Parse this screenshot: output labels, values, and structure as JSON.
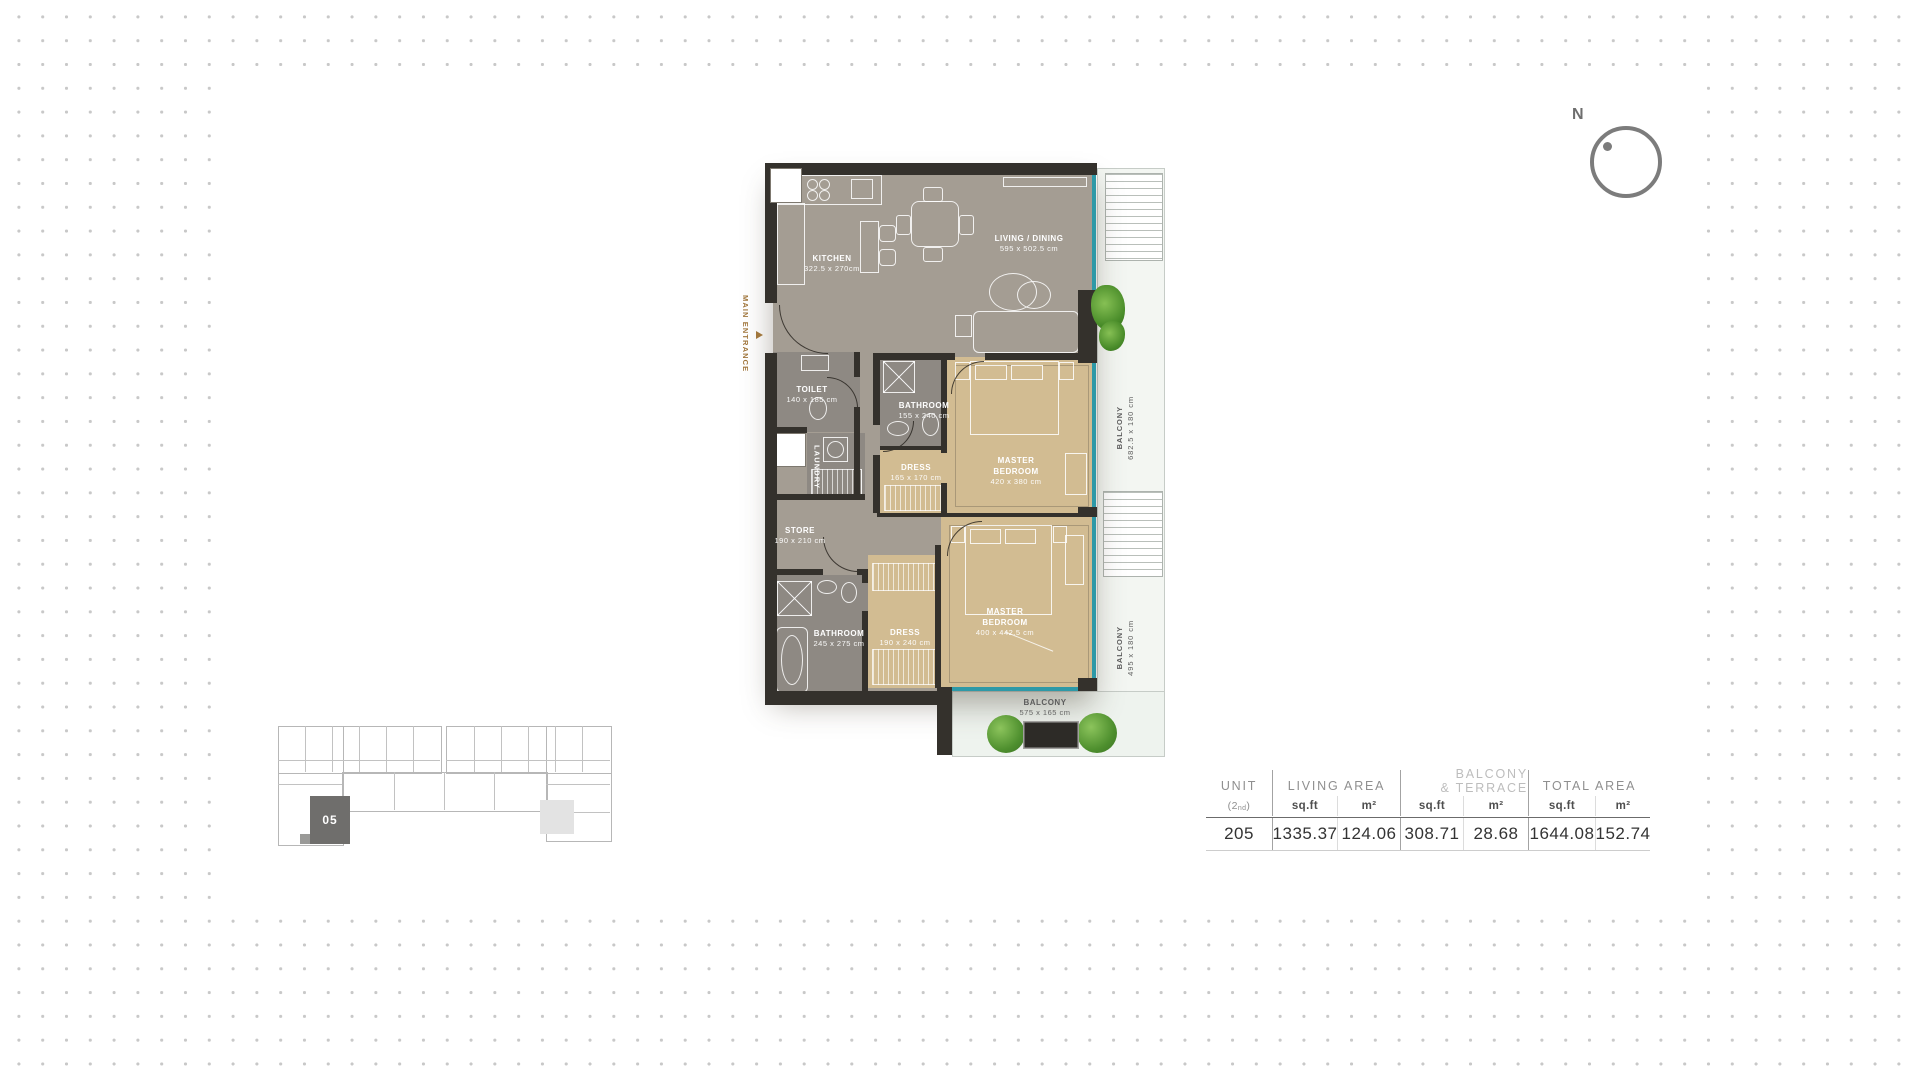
{
  "plan": {
    "entrance_label": "MAIN ENTRANCE",
    "rooms": {
      "kitchen": {
        "name": "KITCHEN",
        "dims": "322.5 x 270cm"
      },
      "living": {
        "name": "LIVING / DINING",
        "dims": "595 x 502.5 cm"
      },
      "toilet": {
        "name": "TOILET",
        "dims": "140 x 185 cm"
      },
      "laundry": {
        "name": "LAUNDRY"
      },
      "store": {
        "name": "STORE",
        "dims": "190 x 210 cm"
      },
      "bathroom_upper": {
        "name": "BATHROOM",
        "dims": "155 x 240 cm"
      },
      "dress_upper": {
        "name": "DRESS",
        "dims": "165 x 170 cm"
      },
      "master_upper": {
        "name": "MASTER BEDROOM",
        "dims": "420 x 380 cm"
      },
      "bathroom_lower": {
        "name": "BATHROOM",
        "dims": "245 x 275 cm"
      },
      "dress_lower": {
        "name": "DRESS",
        "dims": "190 x 240 cm"
      },
      "master_lower": {
        "name": "MASTER BEDROOM",
        "dims": "400 x 442.5 cm"
      },
      "balcony_side_upper": {
        "name": "BALCONY",
        "dims": "682.5 x 180 cm"
      },
      "balcony_side_lower": {
        "name": "BALCONY",
        "dims": "495 x 180 cm"
      },
      "balcony_bottom": {
        "name": "BALCONY",
        "dims": "575 x 165 cm"
      }
    }
  },
  "compass": {
    "north_label": "N"
  },
  "minimap": {
    "unit_label": "05"
  },
  "area_table": {
    "unit_title": "UNIT",
    "floor_open": "(2",
    "floor_sup": "nd",
    "floor_close": ")",
    "living_area_title": "LIVING AREA",
    "balcony_terrace_line1": "BALCONY",
    "balcony_terrace_line2": "& TERRACE",
    "total_area_title": "TOTAL AREA",
    "sqft_label": "sq.ft",
    "m2_label": "m²",
    "row": {
      "unit": "205",
      "living_sqft": "1335.37",
      "living_m2": "124.06",
      "balcony_sqft": "308.71",
      "balcony_m2": "28.68",
      "total_sqft": "1644.08",
      "total_m2": "152.74"
    }
  },
  "colors": {
    "wall": "#34312C",
    "floor_main": "#A49D93",
    "floor_bedroom": "#D2BC92",
    "floor_bath": "#8E8983",
    "glass": "#2E99A7",
    "balcony_floor": "#F3F6F2",
    "entrance_text": "#A0763C",
    "plant_green": "#4E8F2E",
    "highlighted_unit": "#6F6E6C",
    "dot_grid": "#C8C8C8"
  }
}
